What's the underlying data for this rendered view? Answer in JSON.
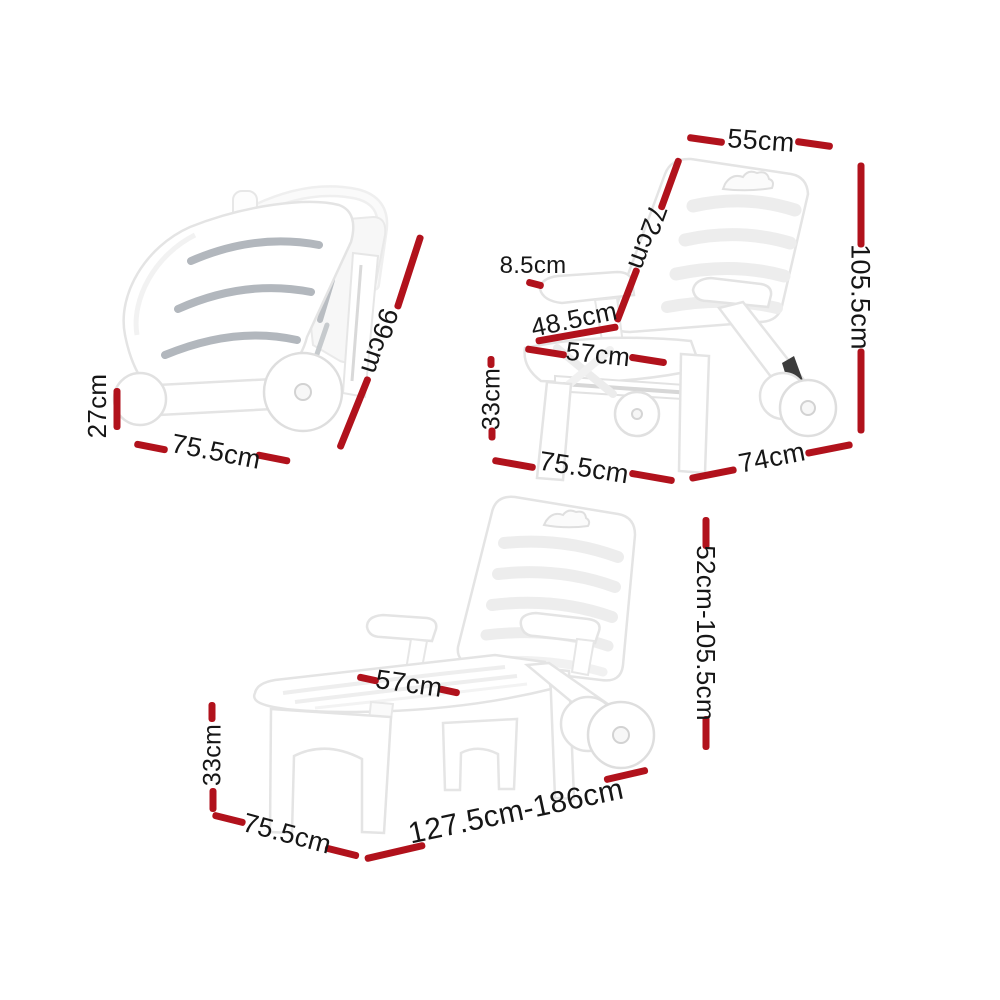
{
  "accent_color": "#b1121c",
  "text_color": "#161616",
  "figures": {
    "folded": {
      "title": "folded sun lounger",
      "dims": {
        "height": "27cm",
        "base_width": "75.5cm",
        "folded_length": "99cm"
      }
    },
    "chair": {
      "title": "upright chair position",
      "dims": {
        "backrest_width": "55cm",
        "backrest_length": "72cm",
        "armrest_height": "8.5cm",
        "seat_depth": "48.5cm",
        "seat_width": "57cm",
        "seat_height": "33cm",
        "base_width": "75.5cm",
        "base_depth": "74cm",
        "overall_height": "105.5cm"
      }
    },
    "lounger": {
      "title": "reclined lounger position",
      "dims": {
        "seat_width": "57cm",
        "seat_height": "33cm",
        "base_width": "75.5cm",
        "overall_length": "127.5cm-186cm",
        "overall_height": "52cm-105.5cm"
      }
    }
  }
}
